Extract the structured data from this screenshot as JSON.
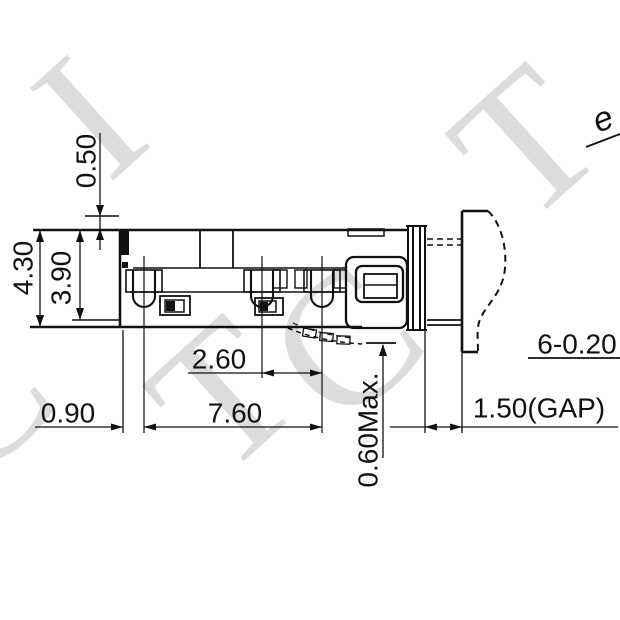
{
  "drawing": {
    "background": "#ffffff",
    "line_color": "#111111",
    "watermark_color": "#dcdcdc",
    "watermark_letters": [
      "T",
      "C",
      "T",
      "I",
      "T",
      "C"
    ],
    "corner_glyph": "e",
    "dims": {
      "top_clearance": "0.50",
      "overall_height": "4.30",
      "inner_height": "3.90",
      "pin_pitch_2_3": "2.60",
      "edge_to_pin1": "0.90",
      "pin1_to_pin3": "7.60",
      "lead_standoff": "0.60Max.",
      "mating_gap": "1.50(GAP)",
      "hole_spec": "6-0.20"
    }
  }
}
